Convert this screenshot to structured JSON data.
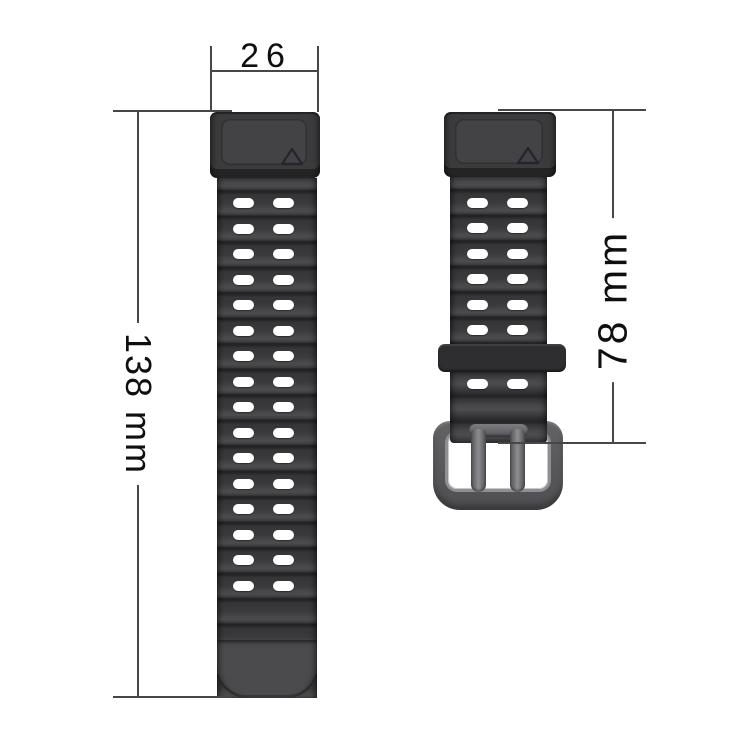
{
  "dimensions": {
    "band_width": "26",
    "long_band_length": "138 mm",
    "short_band_length": "78 mm"
  },
  "long_band": {
    "hole_rows": 16,
    "hole_cols": 2
  },
  "short_band": {
    "upper_hole_rows": 6,
    "lower_hole_rows": 1,
    "hole_cols": 2
  },
  "icons": {
    "connector_marker": "triangle-outline"
  },
  "colors": {
    "band_body": "#3c3c3e",
    "ridge_shadow": "#232326",
    "ridge_highlight": "#4c4c4f",
    "connector": "#3b3b3d",
    "buckle_frame": "#5d5d60",
    "keeper": "#2e2e30",
    "hole_fill": "#ffffff",
    "dimension_line": "#474747",
    "text": "#0f0f0f",
    "background": "#ffffff"
  }
}
